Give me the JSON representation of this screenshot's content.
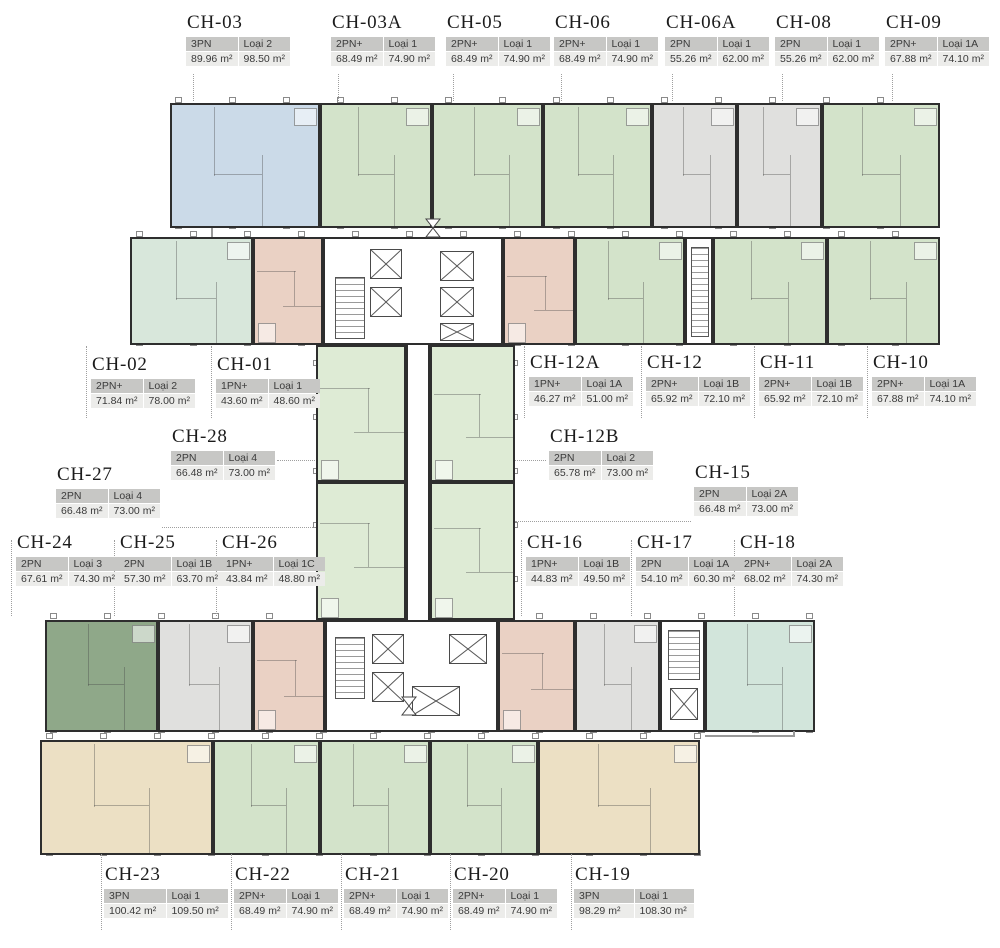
{
  "palette": {
    "green": "#d3e3ca",
    "spine_green": "#deebd5",
    "blue": "#cbdae8",
    "gray": "#e0e0de",
    "salmon": "#ead1c4",
    "mint": "#d8e7db",
    "teal": "#d2e5db",
    "sage": "#8fa889",
    "beige": "#ece0c4",
    "wall": "#2e2e2e",
    "label_header_bg": "#c7c7c5",
    "label_value_bg": "#ececea"
  },
  "units": [
    {
      "id": "CH-03",
      "bedrooms": "3PN",
      "type": "Loại 2",
      "area1": "89.96 m²",
      "area2": "98.50 m²",
      "color": "blue"
    },
    {
      "id": "CH-03A",
      "bedrooms": "2PN+",
      "type": "Loại 1",
      "area1": "68.49 m²",
      "area2": "74.90 m²",
      "color": "green"
    },
    {
      "id": "CH-05",
      "bedrooms": "2PN+",
      "type": "Loại 1",
      "area1": "68.49 m²",
      "area2": "74.90 m²",
      "color": "green"
    },
    {
      "id": "CH-06",
      "bedrooms": "2PN+",
      "type": "Loại 1",
      "area1": "68.49 m²",
      "area2": "74.90 m²",
      "color": "green"
    },
    {
      "id": "CH-06A",
      "bedrooms": "2PN",
      "type": "Loại 1",
      "area1": "55.26 m²",
      "area2": "62.00 m²",
      "color": "gray"
    },
    {
      "id": "CH-08",
      "bedrooms": "2PN",
      "type": "Loại 1",
      "area1": "55.26 m²",
      "area2": "62.00 m²",
      "color": "gray"
    },
    {
      "id": "CH-09",
      "bedrooms": "2PN+",
      "type": "Loại 1A",
      "area1": "67.88 m²",
      "area2": "74.10 m²",
      "color": "green"
    },
    {
      "id": "CH-02",
      "bedrooms": "2PN+",
      "type": "Loại 2",
      "area1": "71.84 m²",
      "area2": "78.00 m²",
      "color": "mint"
    },
    {
      "id": "CH-01",
      "bedrooms": "1PN+",
      "type": "Loại 1",
      "area1": "43.60 m²",
      "area2": "48.60 m²",
      "color": "salmon"
    },
    {
      "id": "CH-12A",
      "bedrooms": "1PN+",
      "type": "Loại 1A",
      "area1": "46.27 m²",
      "area2": "51.00 m²",
      "color": "salmon"
    },
    {
      "id": "CH-12",
      "bedrooms": "2PN+",
      "type": "Loại 1B",
      "area1": "65.92 m²",
      "area2": "72.10 m²",
      "color": "green"
    },
    {
      "id": "CH-11",
      "bedrooms": "2PN+",
      "type": "Loại 1B",
      "area1": "65.92 m²",
      "area2": "72.10 m²",
      "color": "green"
    },
    {
      "id": "CH-10",
      "bedrooms": "2PN+",
      "type": "Loại 1A",
      "area1": "67.88 m²",
      "area2": "74.10 m²",
      "color": "green"
    },
    {
      "id": "CH-28",
      "bedrooms": "2PN",
      "type": "Loại 4",
      "area1": "66.48 m²",
      "area2": "73.00 m²",
      "color": "spine_green"
    },
    {
      "id": "CH-12B",
      "bedrooms": "2PN",
      "type": "Loại 2",
      "area1": "65.78 m²",
      "area2": "73.00 m²",
      "color": "spine_green"
    },
    {
      "id": "CH-27",
      "bedrooms": "2PN",
      "type": "Loại 4",
      "area1": "66.48 m²",
      "area2": "73.00 m²",
      "color": "spine_green"
    },
    {
      "id": "CH-15",
      "bedrooms": "2PN",
      "type": "Loại 2A",
      "area1": "66.48 m²",
      "area2": "73.00 m²",
      "color": "spine_green"
    },
    {
      "id": "CH-24",
      "bedrooms": "2PN",
      "type": "Loại 3",
      "area1": "67.61 m²",
      "area2": "74.30 m²",
      "color": "sage"
    },
    {
      "id": "CH-25",
      "bedrooms": "2PN",
      "type": "Loại 1B",
      "area1": "57.30 m²",
      "area2": "63.70 m²",
      "color": "gray"
    },
    {
      "id": "CH-26",
      "bedrooms": "1PN+",
      "type": "Loại 1C",
      "area1": "43.84 m²",
      "area2": "48.80 m²",
      "color": "salmon"
    },
    {
      "id": "CH-16",
      "bedrooms": "1PN+",
      "type": "Loại 1B",
      "area1": "44.83 m²",
      "area2": "49.50 m²",
      "color": "salmon"
    },
    {
      "id": "CH-17",
      "bedrooms": "2PN",
      "type": "Loại 1A",
      "area1": "54.10 m²",
      "area2": "60.30 m²",
      "color": "gray"
    },
    {
      "id": "CH-18",
      "bedrooms": "2PN+",
      "type": "Loại 2A",
      "area1": "68.02 m²",
      "area2": "74.30 m²",
      "color": "teal"
    },
    {
      "id": "CH-23",
      "bedrooms": "3PN",
      "type": "Loại 1",
      "area1": "100.42 m²",
      "area2": "109.50 m²",
      "color": "beige"
    },
    {
      "id": "CH-22",
      "bedrooms": "2PN+",
      "type": "Loại 1",
      "area1": "68.49 m²",
      "area2": "74.90 m²",
      "color": "green"
    },
    {
      "id": "CH-21",
      "bedrooms": "2PN+",
      "type": "Loại 1",
      "area1": "68.49 m²",
      "area2": "74.90 m²",
      "color": "green"
    },
    {
      "id": "CH-20",
      "bedrooms": "2PN+",
      "type": "Loại 1",
      "area1": "68.49 m²",
      "area2": "74.90 m²",
      "color": "green"
    },
    {
      "id": "CH-19",
      "bedrooms": "3PN",
      "type": "Loại 1",
      "area1": "98.29 m²",
      "area2": "108.30 m²",
      "color": "beige"
    }
  ]
}
